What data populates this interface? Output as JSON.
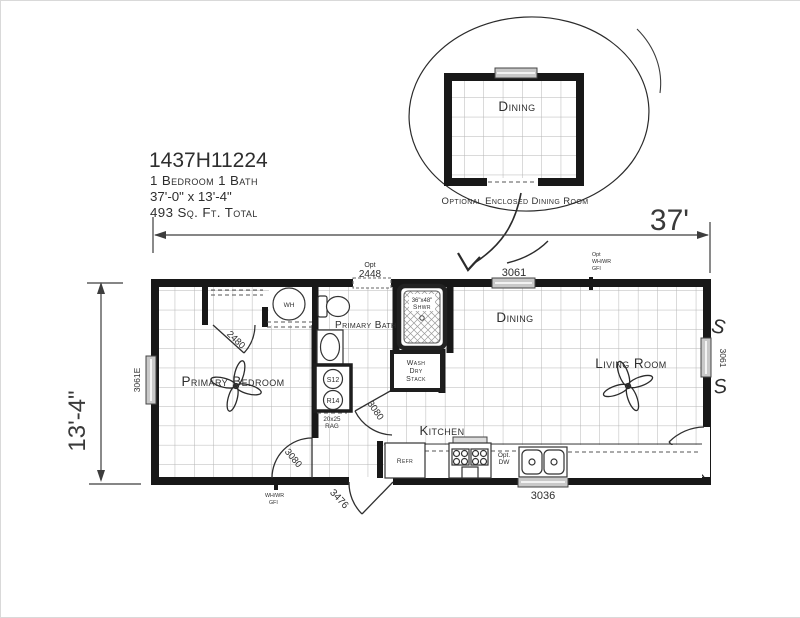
{
  "colors": {
    "wall": "#181818",
    "grid": "#b5b5b5",
    "window": "#c9c9c9",
    "ink": "#2e2e2e"
  },
  "title_block": {
    "model": "1437H11224",
    "config": "1 Bedroom 1 Bath",
    "size": "37'-0\" x 13'-4\"",
    "area": "493 Sq. Ft. Total"
  },
  "dimensions": {
    "width": "37'",
    "height": "13'-4\""
  },
  "inset": {
    "room": "Dining",
    "caption": "Optional Enclosed Dining Room"
  },
  "rooms": {
    "bedroom": "Primary Bedroom",
    "bath": "Primary Bath",
    "dining": "Dining",
    "living": "Living Room",
    "kitchen": "Kitchen"
  },
  "openings": {
    "window_left": "3061E",
    "window_top_opt_l1": "Opt",
    "window_top_opt_l2": "2448",
    "window_top": "3061",
    "window_right": "3061",
    "window_kitchen": "3036",
    "door_closet": "2480",
    "door_bedroom": "3080",
    "door_bath": "3080",
    "door_front": "3080",
    "door_back": "3476"
  },
  "fixtures": {
    "water_heater": "WH",
    "shower_size": "36\"x48\"",
    "shower": "Shwr",
    "stack_l1": "Wash",
    "stack_l2": "Dry",
    "stack_l3": "Stack",
    "register_supply": "S12",
    "register_return": "R14",
    "rag_l1": "20x25",
    "rag_l2": "RAG",
    "refrigerator": "Refr",
    "dishwasher_l1": "Opt.",
    "dishwasher_l2": "DW"
  },
  "electrical": {
    "gfi_top_l1": "Opt",
    "gfi_top_l2": "WH/WR",
    "gfi_top_l3": "GFI",
    "gfi_bottom_l1": "WH/WR",
    "gfi_bottom_l2": "GFI",
    "switch": "S"
  }
}
